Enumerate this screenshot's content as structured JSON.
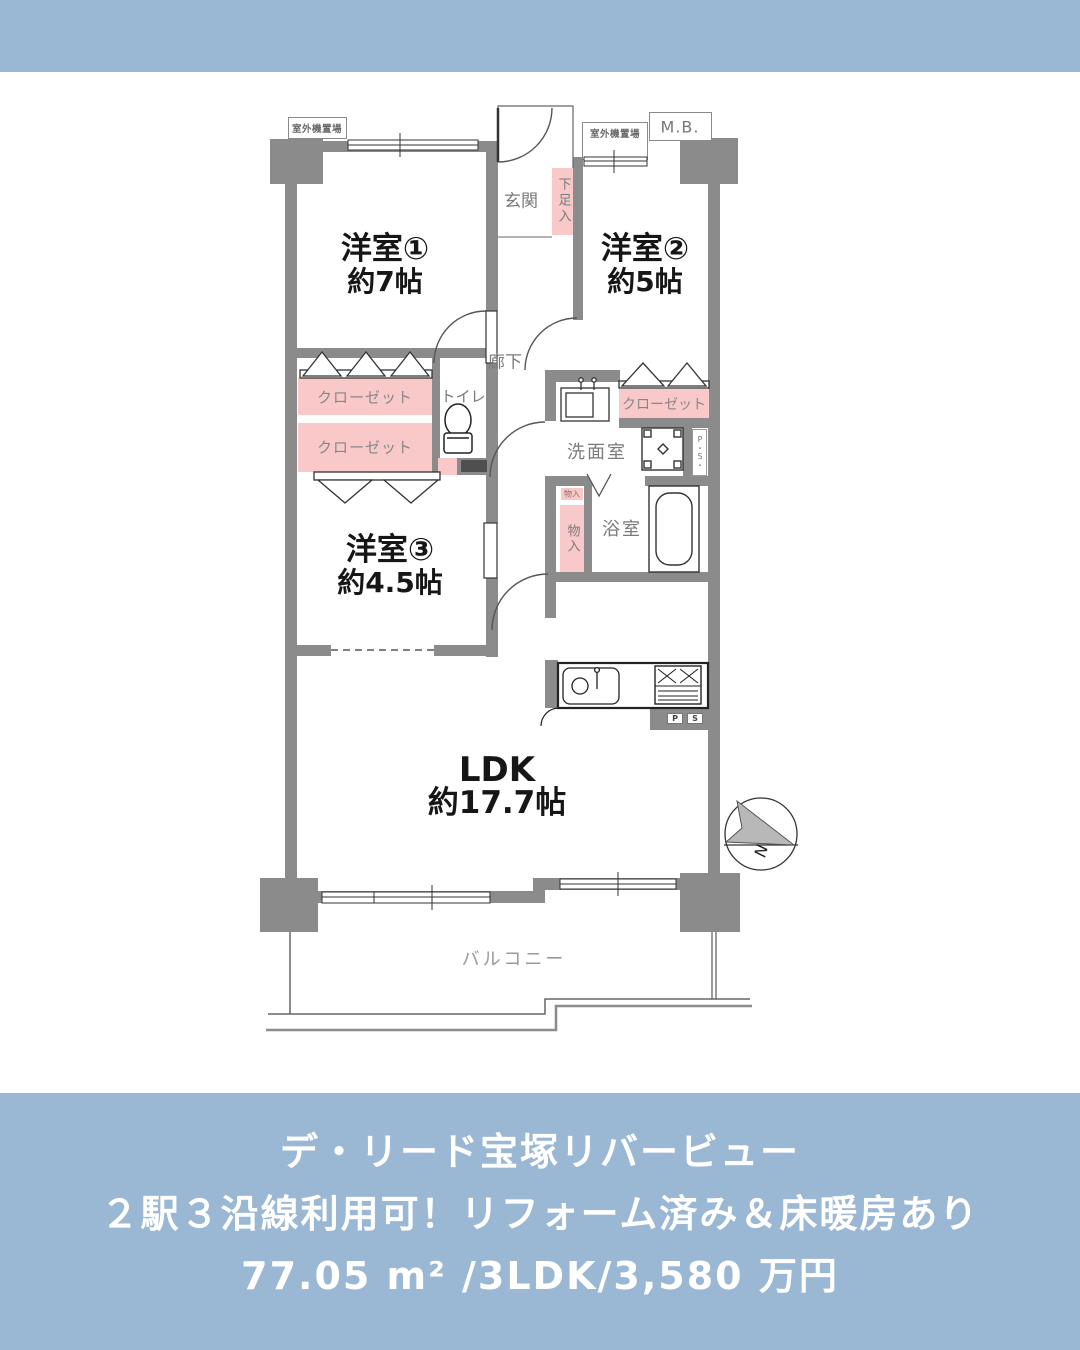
{
  "theme": {
    "band_color": "#9ab7d4",
    "wall_color": "#8b8b8b",
    "closet_pink": "#f9c9c9"
  },
  "floor_plan": {
    "rooms": [
      {
        "name": "洋室①",
        "size": "約7帖"
      },
      {
        "name": "洋室②",
        "size": "約5帖"
      },
      {
        "name": "洋室③",
        "size": "約4.5帖"
      },
      {
        "name": "LDK",
        "size": "約17.7帖"
      }
    ],
    "labels": {
      "outdoor_unit_left": "室外機置場",
      "outdoor_unit_right": "室外機置場",
      "meter_box": "M.B.",
      "genkan": "玄関",
      "shoe_box": "下足入",
      "hallway": "廊下",
      "toilet": "トイレ",
      "closet1": "クローゼット",
      "closet2": "クローゼット",
      "closet3": "クローゼット",
      "washroom": "洗面室",
      "pipe_space_vertical": "P・S・",
      "pipe_space_p": "P",
      "pipe_space_s": "S",
      "storage_small": "物入",
      "storage": "物入",
      "bathroom": "浴室",
      "balcony": "バルコニー",
      "compass_north": "N"
    }
  },
  "footer": {
    "building_name": "デ・リード宝塚リバービュー",
    "catch_copy": "２駅３沿線利用可！リフォーム済み＆床暖房あり",
    "spec": "77.05 m² /3LDK/3,580 万円"
  }
}
